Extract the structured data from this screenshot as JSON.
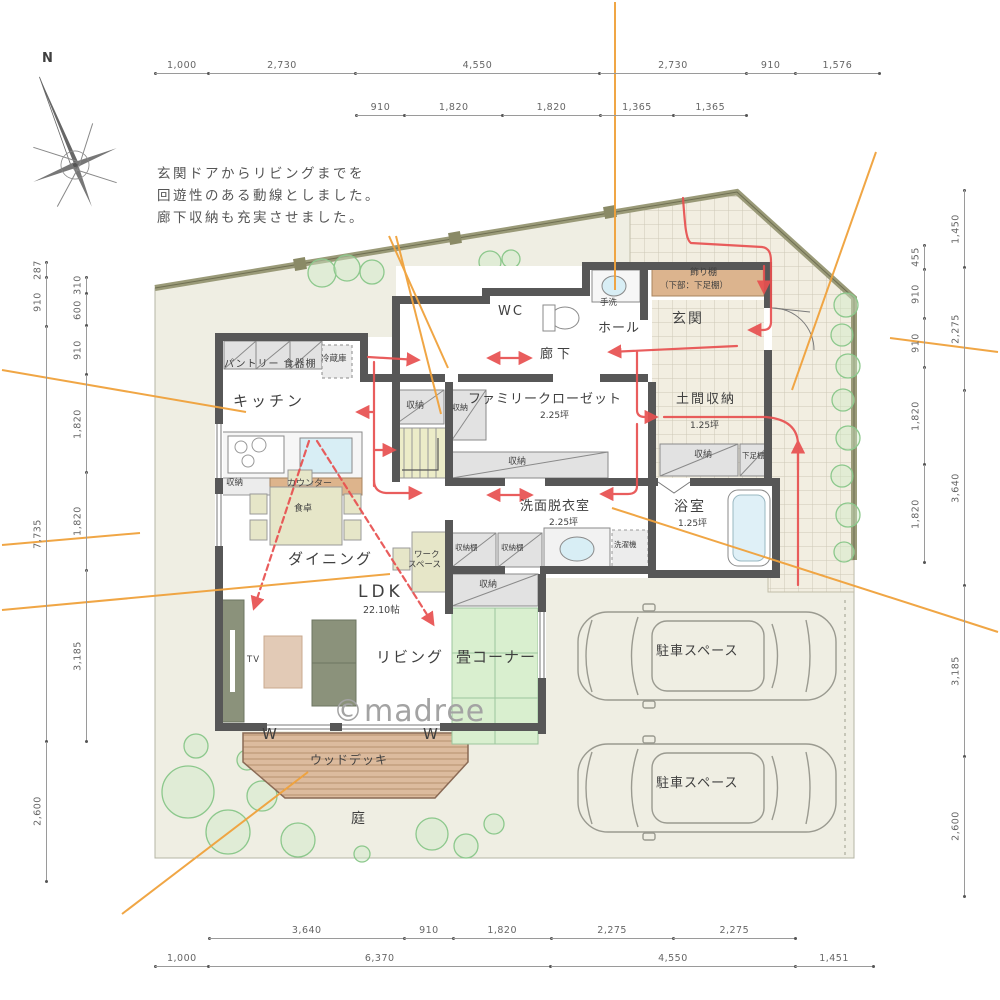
{
  "meta": {
    "watermark": "©madree",
    "north_label": "N"
  },
  "annotation": {
    "line1": "玄関ドアからリビングまでを",
    "line2": "回遊性のある動線としました。",
    "line3": "廊下収納も充実させました。"
  },
  "colors": {
    "lot": "#efeee3",
    "wall": "#575757",
    "tatami": "#d9efcf",
    "deck": "#d9b89b",
    "closet": "#e2e2e2",
    "accent_red": "#e85050",
    "accent_orange": "#f0a23c",
    "tile": "#f2eee1",
    "furniture_olive": "#8b927b",
    "counter_tan": "#ddb48c",
    "water_blue": "#d8eef5",
    "dimension_text": "#666666",
    "label_text": "#3f3f3f",
    "watermark": "#a3a3a3",
    "bush": "#8cc88c"
  },
  "dimensions": {
    "top_outer": [
      "1,000",
      "2,730",
      "4,550",
      "2,730",
      "910",
      "1,576"
    ],
    "top_inner": [
      "910",
      "1,820",
      "1,820",
      "1,365",
      "1,365"
    ],
    "bottom_inner": [
      "3,640",
      "910",
      "1,820",
      "2,275",
      "2,275"
    ],
    "bottom_outer": [
      "1,000",
      "6,370",
      "4,550",
      "1,451"
    ],
    "left_outer": [
      "287",
      "910",
      "7,735",
      "2,600"
    ],
    "left_inner": [
      "310",
      "600",
      "910",
      "1,820",
      "1,820",
      "3,185"
    ],
    "right_inner": [
      "455",
      "910",
      "910",
      "1,820",
      "1,820"
    ],
    "right_outer": [
      "1,450",
      "2,275",
      "3,640",
      "3,185",
      "2,600"
    ]
  },
  "labels": {
    "pantry": "パントリー 食器棚",
    "fridge": "冷蔵庫",
    "kitchen": "キッチン",
    "shuno_kitchen": "収納",
    "counter": "カウンター",
    "shuno_stair": "収納",
    "fc": "ファミリークローゼット",
    "fc_area": "2.25坪",
    "shuno_fc_l": "収納",
    "shuno_fc_b": "収納",
    "wc": "WC",
    "tearai": "手洗",
    "hall": "ホール",
    "genkan": "玄関",
    "rouka": "廊下",
    "kazaridana": "飾り棚",
    "kazaridana2": "（下部：下足棚）",
    "doma": "土間収納",
    "doma_area": "1.25坪",
    "shuno_doma": "収納",
    "getabako": "下足棚",
    "senmen": "洗面脱衣室",
    "senmen_area": "2.25坪",
    "shelf1": "収納棚",
    "shelf2": "収納棚",
    "washer": "洗濯機",
    "bath": "浴室",
    "bath_area": "1.25坪",
    "table": "食卓",
    "dining": "ダイニング",
    "work1": "ワーク",
    "work2": "スペース",
    "ldk": "LDK",
    "ldk_area": "22.10帖",
    "living": "リビング",
    "tv": "TV",
    "tatami": "畳コーナー",
    "shuno_tatami": "収納",
    "deck": "ウッドデッキ",
    "garden": "庭",
    "park1": "駐車スペース",
    "park2": "駐車スペース",
    "w1": "W",
    "w2": "W"
  }
}
